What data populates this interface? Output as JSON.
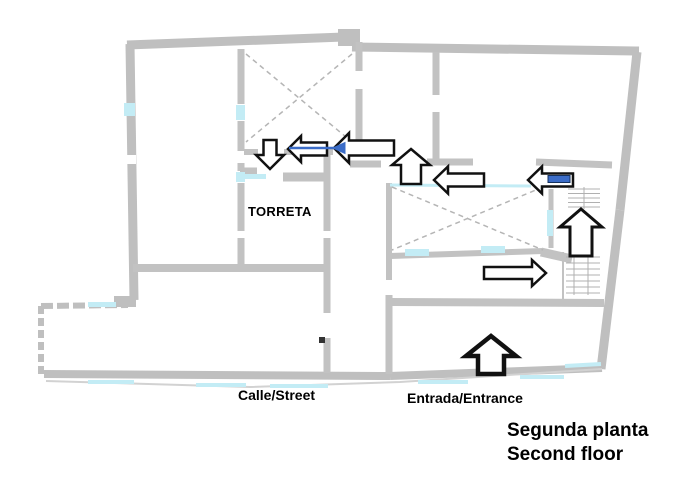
{
  "diagram": {
    "type": "floor-plan-route",
    "labels": {
      "tower_room": "TORRETA",
      "street": "Calle/Street",
      "entrance": "Entrada/Entrance",
      "floor_title_line1": "Segunda planta",
      "floor_title_line2": "Second floor"
    },
    "route_arrows": [
      {
        "direction": "up",
        "at": "entrance-exterior",
        "bold": true
      },
      {
        "direction": "right",
        "at": "lower-stairs-approach"
      },
      {
        "direction": "up",
        "at": "stairwell"
      },
      {
        "direction": "left",
        "at": "upper-landing",
        "has_blue_bar": true
      },
      {
        "direction": "left",
        "at": "upper-corridor-east"
      },
      {
        "direction": "up",
        "at": "corridor-junction"
      },
      {
        "direction": "left",
        "at": "upper-corridor-center"
      },
      {
        "direction": "left",
        "at": "upper-corridor-west"
      },
      {
        "direction": "down",
        "at": "torreta-doorway"
      }
    ],
    "features": {
      "x_marked_rooms": 2,
      "staircases": 2,
      "window_marks": "cyan"
    },
    "colors": {
      "background": "#ffffff",
      "wall": "#bfbfbf",
      "wall_light": "#cfcfcf",
      "window_cyan": "#c3ecf5",
      "route_accent_blue": "#3b6cc7",
      "arrow_fill": "#ffffff",
      "arrow_outline": "#111111",
      "text": "#000000"
    }
  }
}
